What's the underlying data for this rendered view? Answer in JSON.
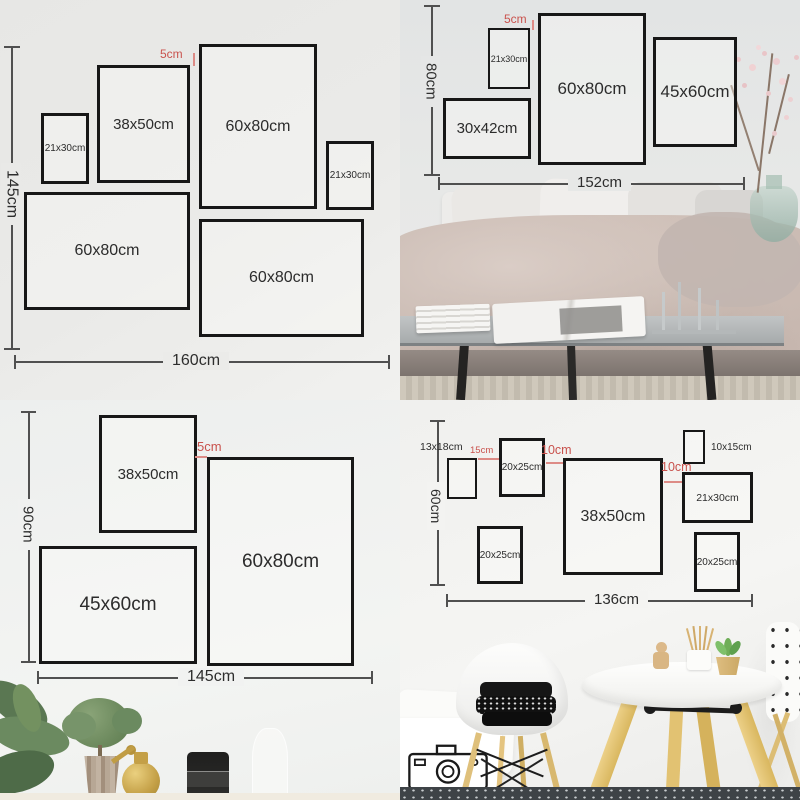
{
  "colors": {
    "frame_border": "#171717",
    "dimension_line": "#505050",
    "red_accent_text": "#c9524d",
    "red_accent_line": "#dd8b86"
  },
  "quadrants": {
    "top_left": {
      "gap_label": "5cm",
      "height_label": "145cm",
      "width_label": "160cm",
      "frames": [
        {
          "label": "21x30cm"
        },
        {
          "label": "38x50cm"
        },
        {
          "label": "60x80cm"
        },
        {
          "label": "21x30cm"
        },
        {
          "label": "60x80cm"
        },
        {
          "label": "60x80cm"
        }
      ]
    },
    "top_right": {
      "gap_label": "5cm",
      "height_label": "80cm",
      "width_label": "152cm",
      "frames": [
        {
          "label": "21x30cm"
        },
        {
          "label": "60x80cm"
        },
        {
          "label": "45x60cm"
        },
        {
          "label": "30x42cm"
        }
      ]
    },
    "bottom_left": {
      "gap_label": "5cm",
      "height_label": "90cm",
      "width_label": "145cm",
      "frames": [
        {
          "label": "38x50cm"
        },
        {
          "label": "60x80cm"
        },
        {
          "label": "45x60cm"
        }
      ]
    },
    "bottom_right": {
      "height_label": "60cm",
      "width_label": "136cm",
      "gap_labels": [
        "15cm",
        "10cm",
        "10cm"
      ],
      "outside_labels": [
        "13x18cm",
        "10x15cm"
      ],
      "frames": [
        {
          "label": "20x25cm"
        },
        {
          "label": "38x50cm"
        },
        {
          "label": "21x30cm"
        },
        {
          "label": "20x25cm"
        },
        {
          "label": "20x25cm"
        }
      ]
    }
  }
}
